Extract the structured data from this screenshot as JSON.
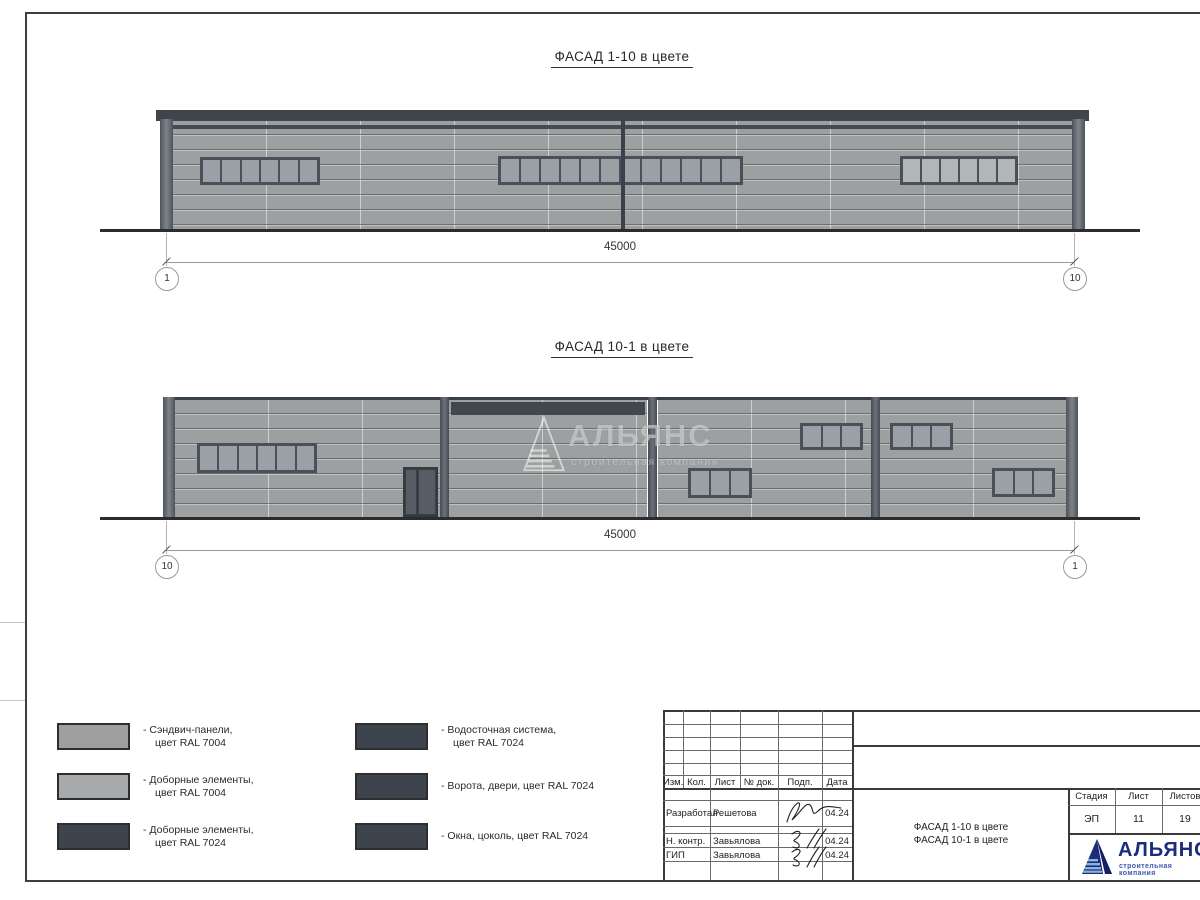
{
  "facade1": {
    "title": "ФАСАД 1-10 в цвете",
    "dimension": "45000",
    "axis_left": "1",
    "axis_right": "10"
  },
  "facade2": {
    "title": "ФАСАД 10-1 в цвете",
    "dimension": "45000",
    "axis_left": "10",
    "axis_right": "1"
  },
  "watermark": {
    "name": "АЛЬЯНС",
    "sub": "строительная компания"
  },
  "legend": {
    "items": [
      {
        "line1": "- Сэндвич-панели,",
        "line2": "цвет RAL 7004",
        "color": "#9d9fa0"
      },
      {
        "line1": "- Доборные элементы,",
        "line2": "цвет RAL 7004",
        "color": "#a7a9aa"
      },
      {
        "line1": "- Доборные элементы,",
        "line2": "цвет RAL 7024",
        "color": "#3e444d"
      },
      {
        "line1": "- Водосточная система,",
        "line2": "цвет RAL 7024",
        "color": "#3e444d"
      },
      {
        "line1": "- Ворота, двери, цвет RAL 7024",
        "line2": "",
        "color": "#3e444d"
      },
      {
        "line1": "- Окна, цоколь, цвет RAL 7024",
        "line2": "",
        "color": "#3e444d"
      }
    ]
  },
  "titleblock": {
    "header": [
      "Изм.",
      "Кол.",
      "Лист",
      "№ док.",
      "Подп.",
      "Дата"
    ],
    "rows": [
      {
        "role": "Разработал",
        "name": "Решетова",
        "date": "04.24"
      },
      {
        "role": "Н. контр.",
        "name": "Завьялова",
        "date": "04.24"
      },
      {
        "role": "ГИП",
        "name": "Завьялова",
        "date": "04.24"
      }
    ],
    "stage_label": "Стадия",
    "stage_value": "ЭП",
    "sheet_label": "Лист",
    "sheet_value": "11",
    "sheets_label": "Листов",
    "sheets_value": "19",
    "doc_title_line1": "ФАСАД 1-10 в цвете",
    "doc_title_line2": "ФАСАД 10-1 в цвете"
  },
  "logo": {
    "name": "АЛЬЯНС",
    "sub": "строительная компания",
    "navy": "#1d2b7d",
    "blue": "#3f58b0"
  }
}
